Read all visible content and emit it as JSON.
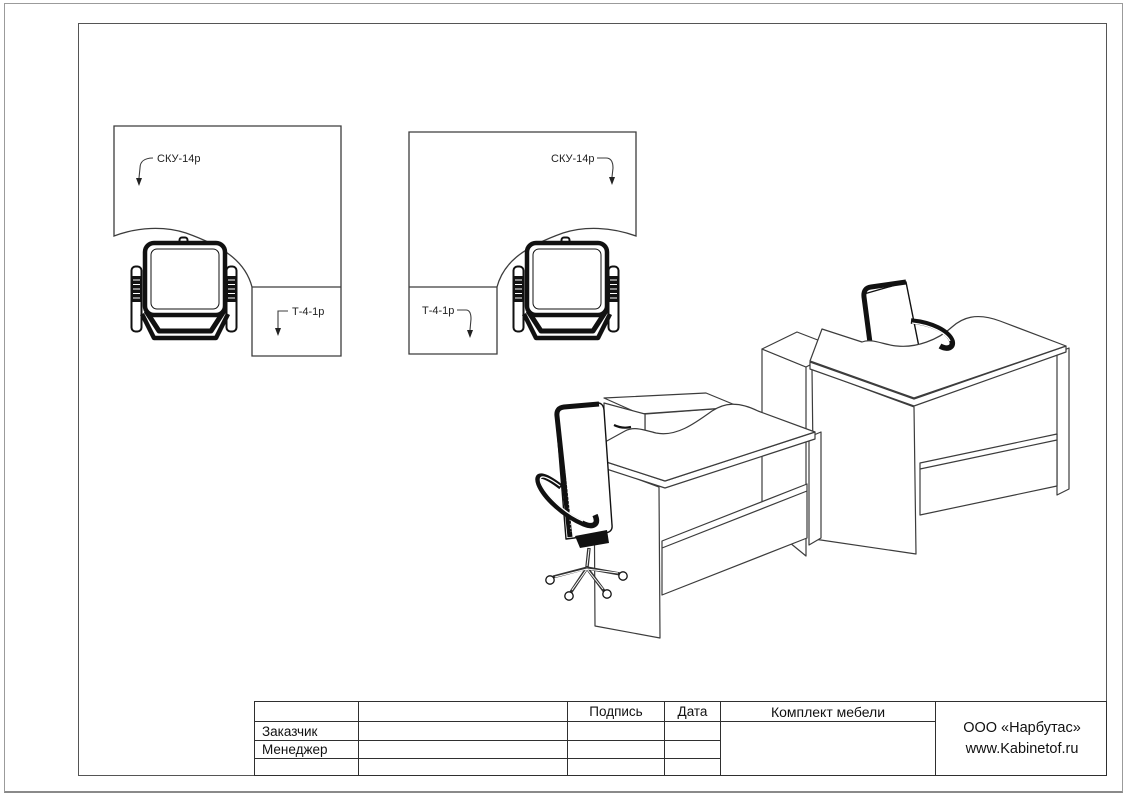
{
  "plan_views": [
    {
      "desk_label": "СКУ-14р",
      "return_label": "Т-4-1р"
    },
    {
      "desk_label": "СКУ-14р",
      "return_label": "Т-4-1р"
    }
  ],
  "title_block": {
    "header": {
      "signature": "Подпись",
      "date": "Дата",
      "set": "Комплект мебели"
    },
    "rows": [
      {
        "label": "Заказчик"
      },
      {
        "label": "Менеджер"
      }
    ],
    "company": {
      "line1": "ООО «Нарбутас»",
      "line2": "www.Kabinetof.ru"
    }
  },
  "colors": {
    "line": "#3c3c3c",
    "chair": "#111111",
    "frame": "#555555",
    "outer_border": "#9b9b9b",
    "table_line": "#2f2f2f"
  }
}
